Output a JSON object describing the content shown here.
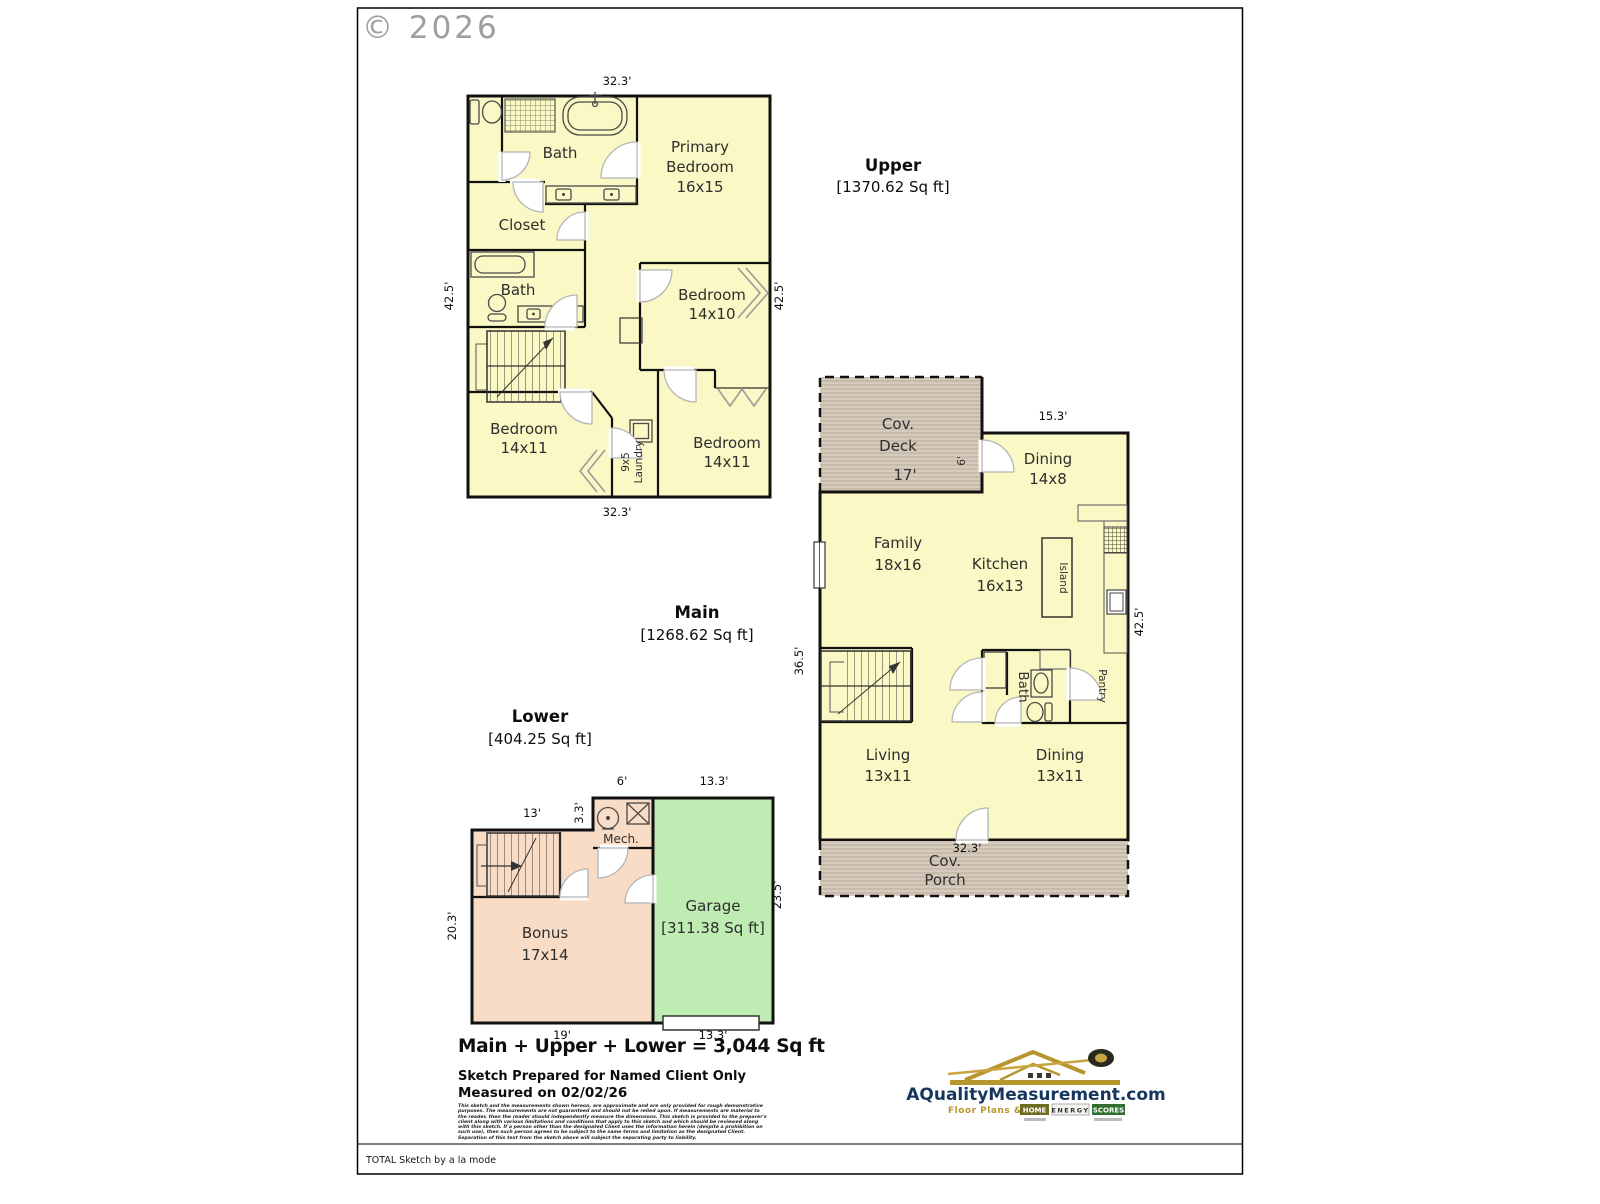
{
  "watermark": "© 2026",
  "colors": {
    "floor_yellow": "#FAF8C4",
    "deck_tan": "#D5CABB",
    "lower_pink": "#F8DCC6",
    "garage_green": "#BFECB2",
    "logo_navy": "#17365D",
    "logo_gold": "#B8962E"
  },
  "upper": {
    "title": "Upper",
    "sqft": "[1370.62 Sq ft]",
    "dim_top": "32.3'",
    "dim_bottom": "32.3'",
    "dim_left": "42.5'",
    "dim_right": "42.5'",
    "bath1": "Bath",
    "primary_l1": "Primary",
    "primary_l2": "Bedroom",
    "primary_l3": "16x15",
    "closet": "Closet",
    "bath2": "Bath",
    "bed2_l1": "Bedroom",
    "bed2_l2": "14x10",
    "bed3_l1": "Bedroom",
    "bed3_l2": "14x11",
    "laundry_l1": "Laundry",
    "laundry_l2": "9x5",
    "bed4_l1": "Bedroom",
    "bed4_l2": "14x11"
  },
  "main": {
    "title": "Main",
    "sqft": "[1268.62 Sq ft]",
    "dim_top": "15.3'",
    "dim_left": "36.5'",
    "dim_right": "42.5'",
    "dim_bottom": "32.3'",
    "dim_deck_depth": "6'",
    "deck_l1": "Cov.",
    "deck_l2": "Deck",
    "deck_l3": "17'",
    "dining1_l1": "Dining",
    "dining1_l2": "14x8",
    "family_l1": "Family",
    "family_l2": "18x16",
    "kitchen_l1": "Kitchen",
    "kitchen_l2": "16x13",
    "island": "Island",
    "bath": "Bath",
    "pantry": "Pantry",
    "living_l1": "Living",
    "living_l2": "13x11",
    "dining2_l1": "Dining",
    "dining2_l2": "13x11",
    "porch_l1": "Cov.",
    "porch_l2": "Porch"
  },
  "lower": {
    "title": "Lower",
    "sqft": "[404.25 Sq ft]",
    "dim_mech": "6'",
    "dim_garage_top": "13.3'",
    "dim_bonus_top": "13'",
    "dim_jog": "3.3'",
    "dim_left": "20.3'",
    "dim_right": "23.5'",
    "dim_bonus_bottom": "19'",
    "dim_garage_bottom": "13.3'",
    "mech": "Mech.",
    "bonus_l1": "Bonus",
    "bonus_l2": "17x14",
    "garage_l1": "Garage",
    "garage_l2": "[311.38 Sq ft]"
  },
  "summary": {
    "total": "Main + Upper + Lower = 3,044 Sq ft",
    "prepared": "Sketch Prepared for Named Client Only",
    "measured": "Measured on 02/02/26",
    "disclaimer": "This sketch and the measurements shown hereon, are approximate and are only provided for rough demonstrative purposes.  The measurements are not guaranteed and should not be relied upon.  If measurements are material to the reader, then the reader should independently measure the dimensions.  This sketch is provided to the preparer's client along with various limitations and conditions that apply to this sketch and which should be reviewed along with this sketch.  If a person other than the designated Client uses the information herein (despite a prohibition on such use), then such person agrees to be subject to the same terms and limitation as the designated Client.  Separation of this text from the sketch above will subject the separating party to liability."
  },
  "logo": {
    "domain": "AQualityMeasurement.com",
    "tagline": "Floor Plans &",
    "badge_home": "HOME",
    "badge_energy": "ENERGY",
    "badge_scores": "SCORES"
  },
  "footer": "TOTAL Sketch by a la mode"
}
